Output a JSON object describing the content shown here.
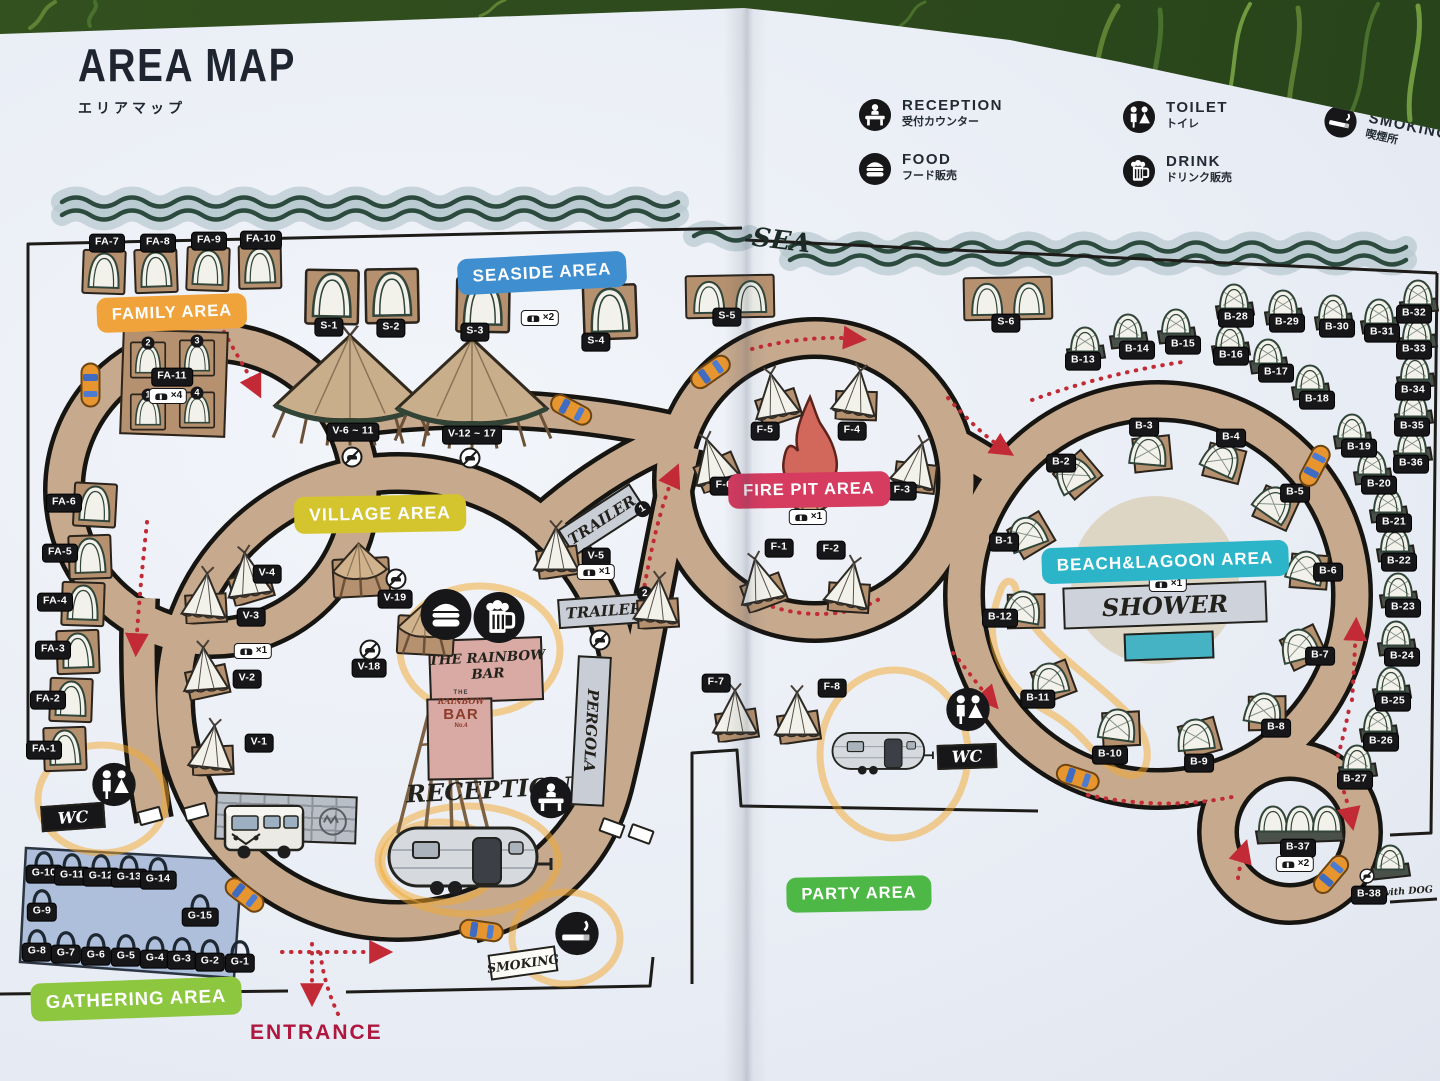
{
  "photo": {
    "title": "AREA MAP",
    "subtitle": "エリアマップ",
    "sea": "SEA",
    "entrance": "ENTRANCE"
  },
  "legend": {
    "items": [
      {
        "icon": "reception-desk-icon",
        "label": "RECEPTION",
        "sub": "受付カウンター"
      },
      {
        "icon": "food-icon",
        "label": "FOOD",
        "sub": "フード販売"
      },
      {
        "icon": "toilet-icon",
        "label": "TOILET",
        "sub": "トイレ"
      },
      {
        "icon": "drink-icon",
        "label": "DRINK",
        "sub": "ドリンク販売"
      },
      {
        "icon": "smoking-icon",
        "label": "SMOKING",
        "sub": "喫煙所"
      }
    ]
  },
  "areas": [
    {
      "label": "FAMILY AREA",
      "color": "#F0A23B",
      "x": 172,
      "y": 313,
      "rot": -2,
      "fs": 16.5
    },
    {
      "label": "SEASIDE AREA",
      "color": "#3E8ED0",
      "x": 542,
      "y": 273,
      "rot": -3,
      "fs": 17
    },
    {
      "label": "VILLAGE AREA",
      "color": "#D4C42E",
      "x": 380,
      "y": 514,
      "rot": -1,
      "fs": 17.5
    },
    {
      "label": "FIRE PIT AREA",
      "color": "#D63B60",
      "x": 809,
      "y": 490,
      "rot": -1,
      "fs": 16.5
    },
    {
      "label": "BEACH&LAGOON AREA",
      "color": "#2CB4C8",
      "x": 1165,
      "y": 562,
      "rot": -2,
      "fs": 17
    },
    {
      "label": "PARTY AREA",
      "color": "#4DB845",
      "x": 859,
      "y": 894,
      "rot": -1,
      "fs": 16.5
    },
    {
      "label": "GATHERING AREA",
      "color": "#8DC63F",
      "x": 136,
      "y": 999,
      "rot": -2,
      "fs": 18.5
    }
  ],
  "map": {
    "sites": [
      {
        "l": "FA-7",
        "x": 104,
        "y": 272,
        "v": "dome",
        "r": 2,
        "cx": 107,
        "cy": 243
      },
      {
        "l": "FA-8",
        "x": 156,
        "y": 271,
        "v": "dome",
        "r": -2,
        "cx": 158,
        "cy": 243
      },
      {
        "l": "FA-9",
        "x": 208,
        "y": 269,
        "v": "dome",
        "r": 2,
        "cx": 209,
        "cy": 241
      },
      {
        "l": "FA-10",
        "x": 260,
        "y": 267,
        "v": "dome",
        "r": -1,
        "cx": 261,
        "cy": 240
      },
      {
        "l": "FA-11",
        "x": 172,
        "y": 377,
        "v": "none",
        "cx": 172,
        "cy": 377
      },
      {
        "l": "",
        "x": 148,
        "y": 360,
        "v": "dome",
        "s": 0.82,
        "n": "2"
      },
      {
        "l": "",
        "x": 197,
        "y": 358,
        "v": "dome",
        "s": 0.82,
        "n": "3"
      },
      {
        "l": "",
        "x": 148,
        "y": 412,
        "v": "dome",
        "s": 0.82,
        "n": "1"
      },
      {
        "l": "",
        "x": 197,
        "y": 410,
        "v": "dome",
        "s": 0.82,
        "n": "4"
      },
      {
        "l": "FA-6",
        "x": 95,
        "y": 505,
        "v": "dome",
        "r": 3,
        "cx": 64,
        "cy": 503
      },
      {
        "l": "FA-5",
        "x": 90,
        "y": 557,
        "v": "dome",
        "r": -2,
        "cx": 60,
        "cy": 553
      },
      {
        "l": "FA-4",
        "x": 83,
        "y": 604,
        "v": "dome",
        "r": 2,
        "cx": 55,
        "cy": 602
      },
      {
        "l": "FA-3",
        "x": 78,
        "y": 652,
        "v": "dome",
        "r": -2,
        "cx": 53,
        "cy": 650
      },
      {
        "l": "FA-2",
        "x": 71,
        "y": 700,
        "v": "dome",
        "r": 2,
        "cx": 48,
        "cy": 700
      },
      {
        "l": "FA-1",
        "x": 65,
        "y": 749,
        "v": "dome",
        "r": -2,
        "cx": 44,
        "cy": 750
      },
      {
        "l": "S-1",
        "x": 332,
        "y": 297,
        "v": "dome",
        "s": 1.25,
        "r": 1,
        "cx": 329,
        "cy": 327
      },
      {
        "l": "S-2",
        "x": 392,
        "y": 296,
        "v": "dome",
        "s": 1.25,
        "r": -1,
        "cx": 391,
        "cy": 328
      },
      {
        "l": "S-3",
        "x": 483,
        "y": 305,
        "v": "dome",
        "s": 1.25,
        "r": 1,
        "cx": 475,
        "cy": 332
      },
      {
        "l": "S-4",
        "x": 610,
        "y": 312,
        "v": "dome",
        "s": 1.25,
        "r": -2,
        "cx": 596,
        "cy": 342
      },
      {
        "l": "S-5",
        "x": 730,
        "y": 298,
        "v": "dome2",
        "r": -1,
        "cx": 727,
        "cy": 317
      },
      {
        "l": "S-6",
        "x": 1008,
        "y": 300,
        "v": "dome2",
        "r": -1,
        "cx": 1006,
        "cy": 323
      },
      {
        "l": "V-6 ~ 11",
        "x": 350,
        "y": 390,
        "v": "btipi",
        "cx": 353,
        "cy": 432
      },
      {
        "l": "V-12 ~ 17",
        "x": 472,
        "y": 393,
        "v": "btipi",
        "cx": 472,
        "cy": 435
      },
      {
        "l": "V-4",
        "x": 248,
        "y": 577,
        "v": "itipi",
        "r": -8,
        "cx": 267,
        "cy": 574
      },
      {
        "l": "V-3",
        "x": 205,
        "y": 598,
        "v": "itipi",
        "r": 5,
        "cx": 251,
        "cy": 617
      },
      {
        "l": "V-2",
        "x": 205,
        "y": 672,
        "v": "itipi",
        "r": -4,
        "cx": 247,
        "cy": 679
      },
      {
        "l": "V-1",
        "x": 212,
        "y": 750,
        "v": "itipi",
        "r": 6,
        "cx": 259,
        "cy": 743
      },
      {
        "l": "V-19",
        "x": 360,
        "y": 572,
        "v": "canopy",
        "r": -3,
        "cx": 395,
        "cy": 599
      },
      {
        "l": "V-18",
        "x": 425,
        "y": 630,
        "v": "canopy",
        "r": 3,
        "cx": 369,
        "cy": 668
      },
      {
        "l": "V-5",
        "x": 556,
        "y": 552,
        "v": "itipi",
        "r": 0,
        "cx": 596,
        "cy": 557
      },
      {
        "l": "",
        "x": 657,
        "y": 603,
        "v": "itipi",
        "r": 5
      },
      {
        "l": "F-5",
        "x": 775,
        "y": 398,
        "v": "itipi",
        "r": -10,
        "cx": 765,
        "cy": 431
      },
      {
        "l": "F-4",
        "x": 856,
        "y": 395,
        "v": "itipi",
        "r": 10,
        "cx": 852,
        "cy": 431
      },
      {
        "l": "F-6",
        "x": 713,
        "y": 463,
        "v": "itipi",
        "r": -15,
        "cx": 724,
        "cy": 486
      },
      {
        "l": "F-3",
        "x": 916,
        "y": 467,
        "v": "itipi",
        "r": 15,
        "cx": 902,
        "cy": 491
      },
      {
        "l": "F-1",
        "x": 760,
        "y": 583,
        "v": "itipi",
        "r": -12,
        "cx": 779,
        "cy": 548
      },
      {
        "l": "F-2",
        "x": 849,
        "y": 587,
        "v": "itipi",
        "r": 12,
        "cx": 831,
        "cy": 550
      },
      {
        "l": "F-7",
        "x": 735,
        "y": 715,
        "v": "itipi",
        "r": 0,
        "cx": 716,
        "cy": 683
      },
      {
        "l": "F-8",
        "x": 797,
        "y": 717,
        "v": "itipi",
        "r": 0,
        "cx": 832,
        "cy": 688
      },
      {
        "l": "B-1",
        "x": 1028,
        "y": 538,
        "v": "bdome",
        "r": -20,
        "cx": 1004,
        "cy": 542
      },
      {
        "l": "B-2",
        "x": 1075,
        "y": 478,
        "v": "bdome",
        "r": -30,
        "cx": 1061,
        "cy": 463
      },
      {
        "l": "B-3",
        "x": 1148,
        "y": 455,
        "v": "bdome",
        "r": 5,
        "cx": 1144,
        "cy": 427
      },
      {
        "l": "B-4",
        "x": 1220,
        "y": 463,
        "v": "bdome",
        "r": 25,
        "cx": 1231,
        "cy": 438
      },
      {
        "l": "B-5",
        "x": 1272,
        "y": 507,
        "v": "bdome",
        "r": 35,
        "cx": 1295,
        "cy": 493
      },
      {
        "l": "B-6",
        "x": 1305,
        "y": 572,
        "v": "bdome",
        "r": 15,
        "cx": 1328,
        "cy": 572
      },
      {
        "l": "B-7",
        "x": 1300,
        "y": 650,
        "v": "bdome",
        "r": -15,
        "cx": 1320,
        "cy": 656
      },
      {
        "l": "B-8",
        "x": 1263,
        "y": 714,
        "v": "bdome",
        "r": 10,
        "cx": 1276,
        "cy": 728
      },
      {
        "l": "B-9",
        "x": 1196,
        "y": 740,
        "v": "bdome",
        "r": -5,
        "cx": 1199,
        "cy": 763
      },
      {
        "l": "B-10",
        "x": 1117,
        "y": 730,
        "v": "bdome",
        "r": 8,
        "cx": 1110,
        "cy": 755
      },
      {
        "l": "B-11",
        "x": 1050,
        "y": 684,
        "v": "bdome",
        "r": -10,
        "cx": 1038,
        "cy": 699
      },
      {
        "l": "B-12",
        "x": 1022,
        "y": 612,
        "v": "bdome",
        "r": 10,
        "cx": 1000,
        "cy": 618
      },
      {
        "l": "B-13",
        "x": 1085,
        "y": 344,
        "v": "odome",
        "cx": 1083,
        "cy": 361
      },
      {
        "l": "B-14",
        "x": 1128,
        "y": 331,
        "v": "odome",
        "cx": 1137,
        "cy": 350
      },
      {
        "l": "B-15",
        "x": 1176,
        "y": 326,
        "v": "odome",
        "cx": 1183,
        "cy": 345
      },
      {
        "l": "B-16",
        "x": 1230,
        "y": 341,
        "v": "odome",
        "cx": 1231,
        "cy": 356
      },
      {
        "l": "B-17",
        "x": 1268,
        "y": 356,
        "v": "odome",
        "cx": 1276,
        "cy": 373
      },
      {
        "l": "B-18",
        "x": 1310,
        "y": 382,
        "v": "odome",
        "cx": 1317,
        "cy": 400
      },
      {
        "l": "B-28",
        "x": 1234,
        "y": 301,
        "v": "odome",
        "cx": 1236,
        "cy": 318
      },
      {
        "l": "B-29",
        "x": 1283,
        "y": 307,
        "v": "odome",
        "cx": 1287,
        "cy": 323
      },
      {
        "l": "B-30",
        "x": 1333,
        "y": 312,
        "v": "odome",
        "cx": 1337,
        "cy": 328
      },
      {
        "l": "B-31",
        "x": 1379,
        "y": 316,
        "v": "odome",
        "cx": 1382,
        "cy": 333
      },
      {
        "l": "B-32",
        "x": 1418,
        "y": 297,
        "v": "odome",
        "cx": 1414,
        "cy": 314
      },
      {
        "l": "B-33",
        "x": 1417,
        "y": 333,
        "v": "odome",
        "cx": 1414,
        "cy": 350
      },
      {
        "l": "B-34",
        "x": 1415,
        "y": 372,
        "v": "odome",
        "cx": 1413,
        "cy": 391
      },
      {
        "l": "B-35",
        "x": 1413,
        "y": 409,
        "v": "odome",
        "cx": 1412,
        "cy": 427
      },
      {
        "l": "B-36",
        "x": 1412,
        "y": 446,
        "v": "odome",
        "cx": 1411,
        "cy": 464
      },
      {
        "l": "B-19",
        "x": 1352,
        "y": 431,
        "v": "odome",
        "cx": 1359,
        "cy": 448
      },
      {
        "l": "B-20",
        "x": 1372,
        "y": 467,
        "v": "odome",
        "cx": 1379,
        "cy": 485
      },
      {
        "l": "B-21",
        "x": 1388,
        "y": 505,
        "v": "odome",
        "cx": 1394,
        "cy": 523
      },
      {
        "l": "B-22",
        "x": 1395,
        "y": 544,
        "v": "odome",
        "cx": 1399,
        "cy": 562
      },
      {
        "l": "B-23",
        "x": 1398,
        "y": 590,
        "v": "odome",
        "cx": 1403,
        "cy": 608
      },
      {
        "l": "B-24",
        "x": 1396,
        "y": 638,
        "v": "odome",
        "cx": 1402,
        "cy": 657
      },
      {
        "l": "B-25",
        "x": 1391,
        "y": 684,
        "v": "odome",
        "cx": 1393,
        "cy": 702
      },
      {
        "l": "B-26",
        "x": 1378,
        "y": 724,
        "v": "odome",
        "cx": 1381,
        "cy": 742
      },
      {
        "l": "B-27",
        "x": 1357,
        "y": 762,
        "v": "odome",
        "cx": 1355,
        "cy": 780
      },
      {
        "l": "B-37",
        "x": 1300,
        "y": 824,
        "v": "ldome",
        "cx": 1298,
        "cy": 848
      },
      {
        "l": "B-38",
        "x": 1390,
        "y": 862,
        "v": "odome",
        "cx": 1369,
        "cy": 895
      },
      {
        "l": "G-10",
        "x": 44,
        "y": 858,
        "v": "gdome",
        "cx": 44,
        "cy": 874
      },
      {
        "l": "G-11",
        "x": 72,
        "y": 860,
        "v": "gdome",
        "cx": 72,
        "cy": 876
      },
      {
        "l": "G-12",
        "x": 101,
        "y": 861,
        "v": "gdome",
        "cx": 101,
        "cy": 877
      },
      {
        "l": "G-13",
        "x": 129,
        "y": 862,
        "v": "gdome",
        "cx": 129,
        "cy": 878
      },
      {
        "l": "G-14",
        "x": 158,
        "y": 864,
        "v": "gdome",
        "cx": 158,
        "cy": 880
      },
      {
        "l": "G-9",
        "x": 42,
        "y": 896,
        "v": "gdome",
        "cx": 42,
        "cy": 912
      },
      {
        "l": "G-15",
        "x": 200,
        "y": 901,
        "v": "gdome",
        "cx": 200,
        "cy": 917
      },
      {
        "l": "G-8",
        "x": 37,
        "y": 936,
        "v": "gdome",
        "cx": 37,
        "cy": 952
      },
      {
        "l": "G-7",
        "x": 66,
        "y": 938,
        "v": "gdome",
        "cx": 66,
        "cy": 954
      },
      {
        "l": "G-6",
        "x": 96,
        "y": 940,
        "v": "gdome",
        "cx": 96,
        "cy": 956
      },
      {
        "l": "G-5",
        "x": 126,
        "y": 941,
        "v": "gdome",
        "cx": 126,
        "cy": 957
      },
      {
        "l": "G-4",
        "x": 155,
        "y": 943,
        "v": "gdome",
        "cx": 155,
        "cy": 959
      },
      {
        "l": "G-3",
        "x": 182,
        "y": 944,
        "v": "gdome",
        "cx": 182,
        "cy": 960
      },
      {
        "l": "G-2",
        "x": 210,
        "y": 946,
        "v": "gdome",
        "cx": 210,
        "cy": 962
      },
      {
        "l": "G-1",
        "x": 240,
        "y": 947,
        "v": "gdome",
        "cx": 240,
        "cy": 963
      }
    ],
    "car_tags": [
      {
        "x": 168,
        "y": 396,
        "label": "×4"
      },
      {
        "x": 540,
        "y": 318,
        "label": "×2"
      },
      {
        "x": 253,
        "y": 651,
        "label": "×1"
      },
      {
        "x": 596,
        "y": 572,
        "label": "×1"
      },
      {
        "x": 808,
        "y": 517,
        "label": "×1"
      },
      {
        "x": 1168,
        "y": 584,
        "label": "×1"
      },
      {
        "x": 1295,
        "y": 864,
        "label": "×2"
      }
    ],
    "no_car_tags": [
      {
        "x": 352,
        "y": 457
      },
      {
        "x": 470,
        "y": 458
      },
      {
        "x": 396,
        "y": 579
      },
      {
        "x": 370,
        "y": 650
      },
      {
        "x": 600,
        "y": 640
      },
      {
        "x": 1367,
        "y": 876,
        "s": 0.72
      }
    ],
    "crossings": [
      {
        "x": 150,
        "y": 816,
        "r": -15
      },
      {
        "x": 196,
        "y": 812,
        "r": -15
      },
      {
        "x": 612,
        "y": 828,
        "r": 20
      },
      {
        "x": 641,
        "y": 834,
        "r": 20
      }
    ],
    "cars": [
      {
        "x": 88,
        "y": 385,
        "r": 90
      },
      {
        "x": 570,
        "y": 412,
        "r": 28
      },
      {
        "x": 712,
        "y": 374,
        "r": -35
      },
      {
        "x": 243,
        "y": 897,
        "r": 38
      },
      {
        "x": 481,
        "y": 933,
        "r": 8
      },
      {
        "x": 1317,
        "y": 467,
        "r": -62
      },
      {
        "x": 1077,
        "y": 780,
        "r": 18
      },
      {
        "x": 1333,
        "y": 876,
        "r": -50
      }
    ],
    "facilities": [
      {
        "icon": "toilet-icon",
        "x": 114,
        "y": 787,
        "s": 46
      },
      {
        "icon": "toilet-icon",
        "x": 968,
        "y": 712,
        "s": 46
      },
      {
        "icon": "reception-desk-icon",
        "x": 551,
        "y": 800,
        "s": 44
      },
      {
        "icon": "smoking-icon",
        "x": 577,
        "y": 936,
        "s": 46
      },
      {
        "icon": "food-icon",
        "x": 446,
        "y": 617,
        "s": 54
      },
      {
        "icon": "drink-icon",
        "x": 499,
        "y": 620,
        "s": 54
      }
    ],
    "buildings": {
      "trailer1": {
        "label": "TRAILER",
        "num": "1"
      },
      "trailer2": {
        "label": "TRAILER",
        "num": "2"
      },
      "pergola": "PERGOLA",
      "shower": "SHOWER",
      "rainbow_bar": {
        "sign": "THE RAINBOW BAR",
        "logo": [
          "THE",
          "RAINBOW",
          "BAR",
          "No.4"
        ]
      },
      "reception": "RECEPTION",
      "wc": "WC",
      "smoking_sign": "SMOKING",
      "with_dog": "with DOG"
    }
  },
  "colors": {
    "road": "#c7aa8e",
    "road_edge": "#171511",
    "platform": "#b5916f",
    "tent": "#f2f2ea",
    "tent_line": "#31453a",
    "sea_wave": "#2c4a3e",
    "sea_halo": "#b6c8ce",
    "arrow": "#c22b35",
    "highlight": "#f4a72c",
    "entrance_text": "#b0173f",
    "gathering_bg": "#aabcd9",
    "pool": "#45b3c4",
    "chip_bg": "#17171a"
  }
}
